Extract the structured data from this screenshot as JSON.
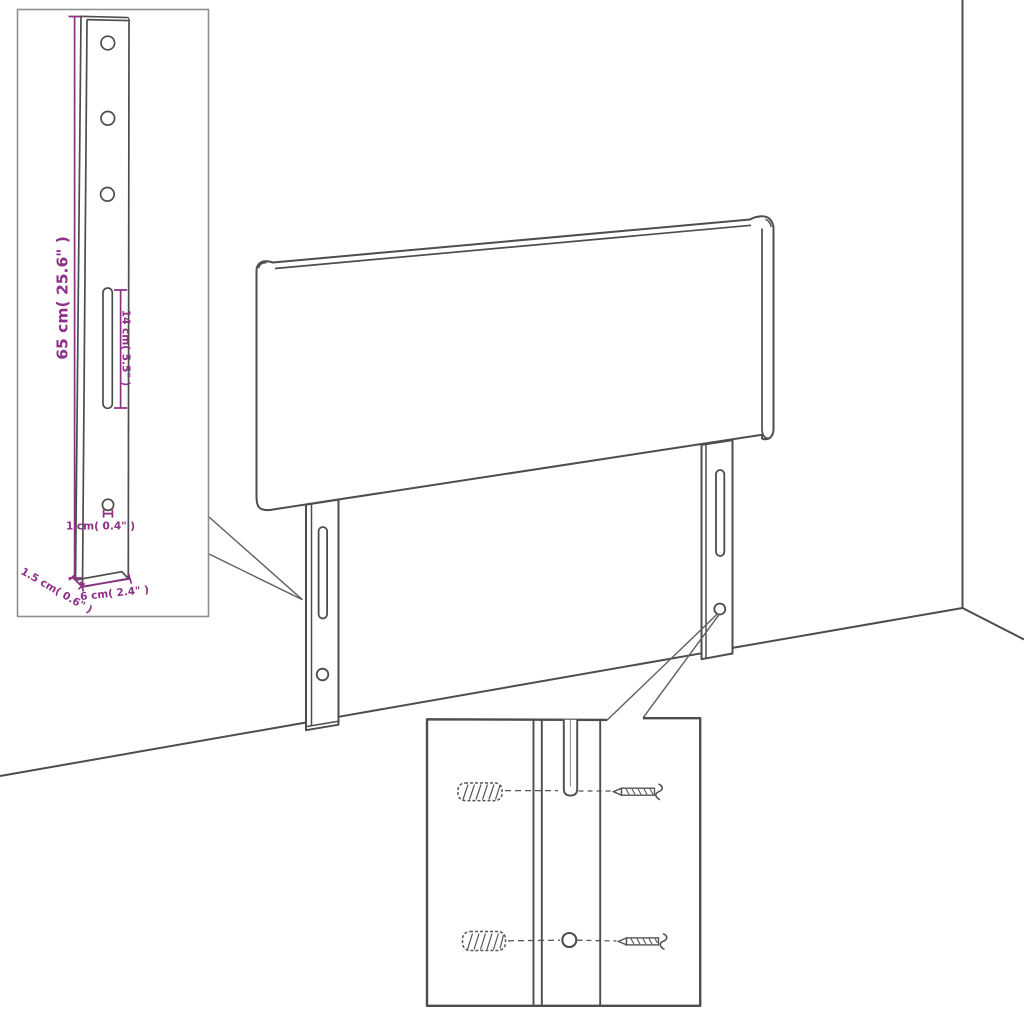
{
  "page": {
    "title": "Headboard with mounting legs - dimension diagram",
    "background": "#ffffff"
  },
  "colors": {
    "drawing_line": "#4d4d4d",
    "dimension": "#8e2f88",
    "inset_border": "#8f8f8f",
    "hardware": "#555555"
  },
  "leg_detail_inset": {
    "dimensions": {
      "leg_height": "65 cm( 25.6\" )",
      "slot_length": "14 cm( 5.5\" )",
      "hole_diameter": "1 cm( 0.4\" )",
      "leg_thickness": "1.5 cm( 0.6\" )",
      "leg_width": "6 cm( 2.4\" )"
    },
    "features": [
      "three round holes",
      "long vertical slot",
      "small round hole"
    ]
  },
  "scene": {
    "objects": [
      "headboard panel",
      "left mounting leg",
      "right mounting leg",
      "wall corner",
      "floor line"
    ],
    "leg_features": [
      "vertical adjustment slot",
      "round mounting hole"
    ]
  },
  "mounting_detail_inset": {
    "hardware": [
      "wall plug",
      "screw",
      "wall plug",
      "screw"
    ],
    "features": [
      "adjustment slot",
      "round hole"
    ]
  }
}
